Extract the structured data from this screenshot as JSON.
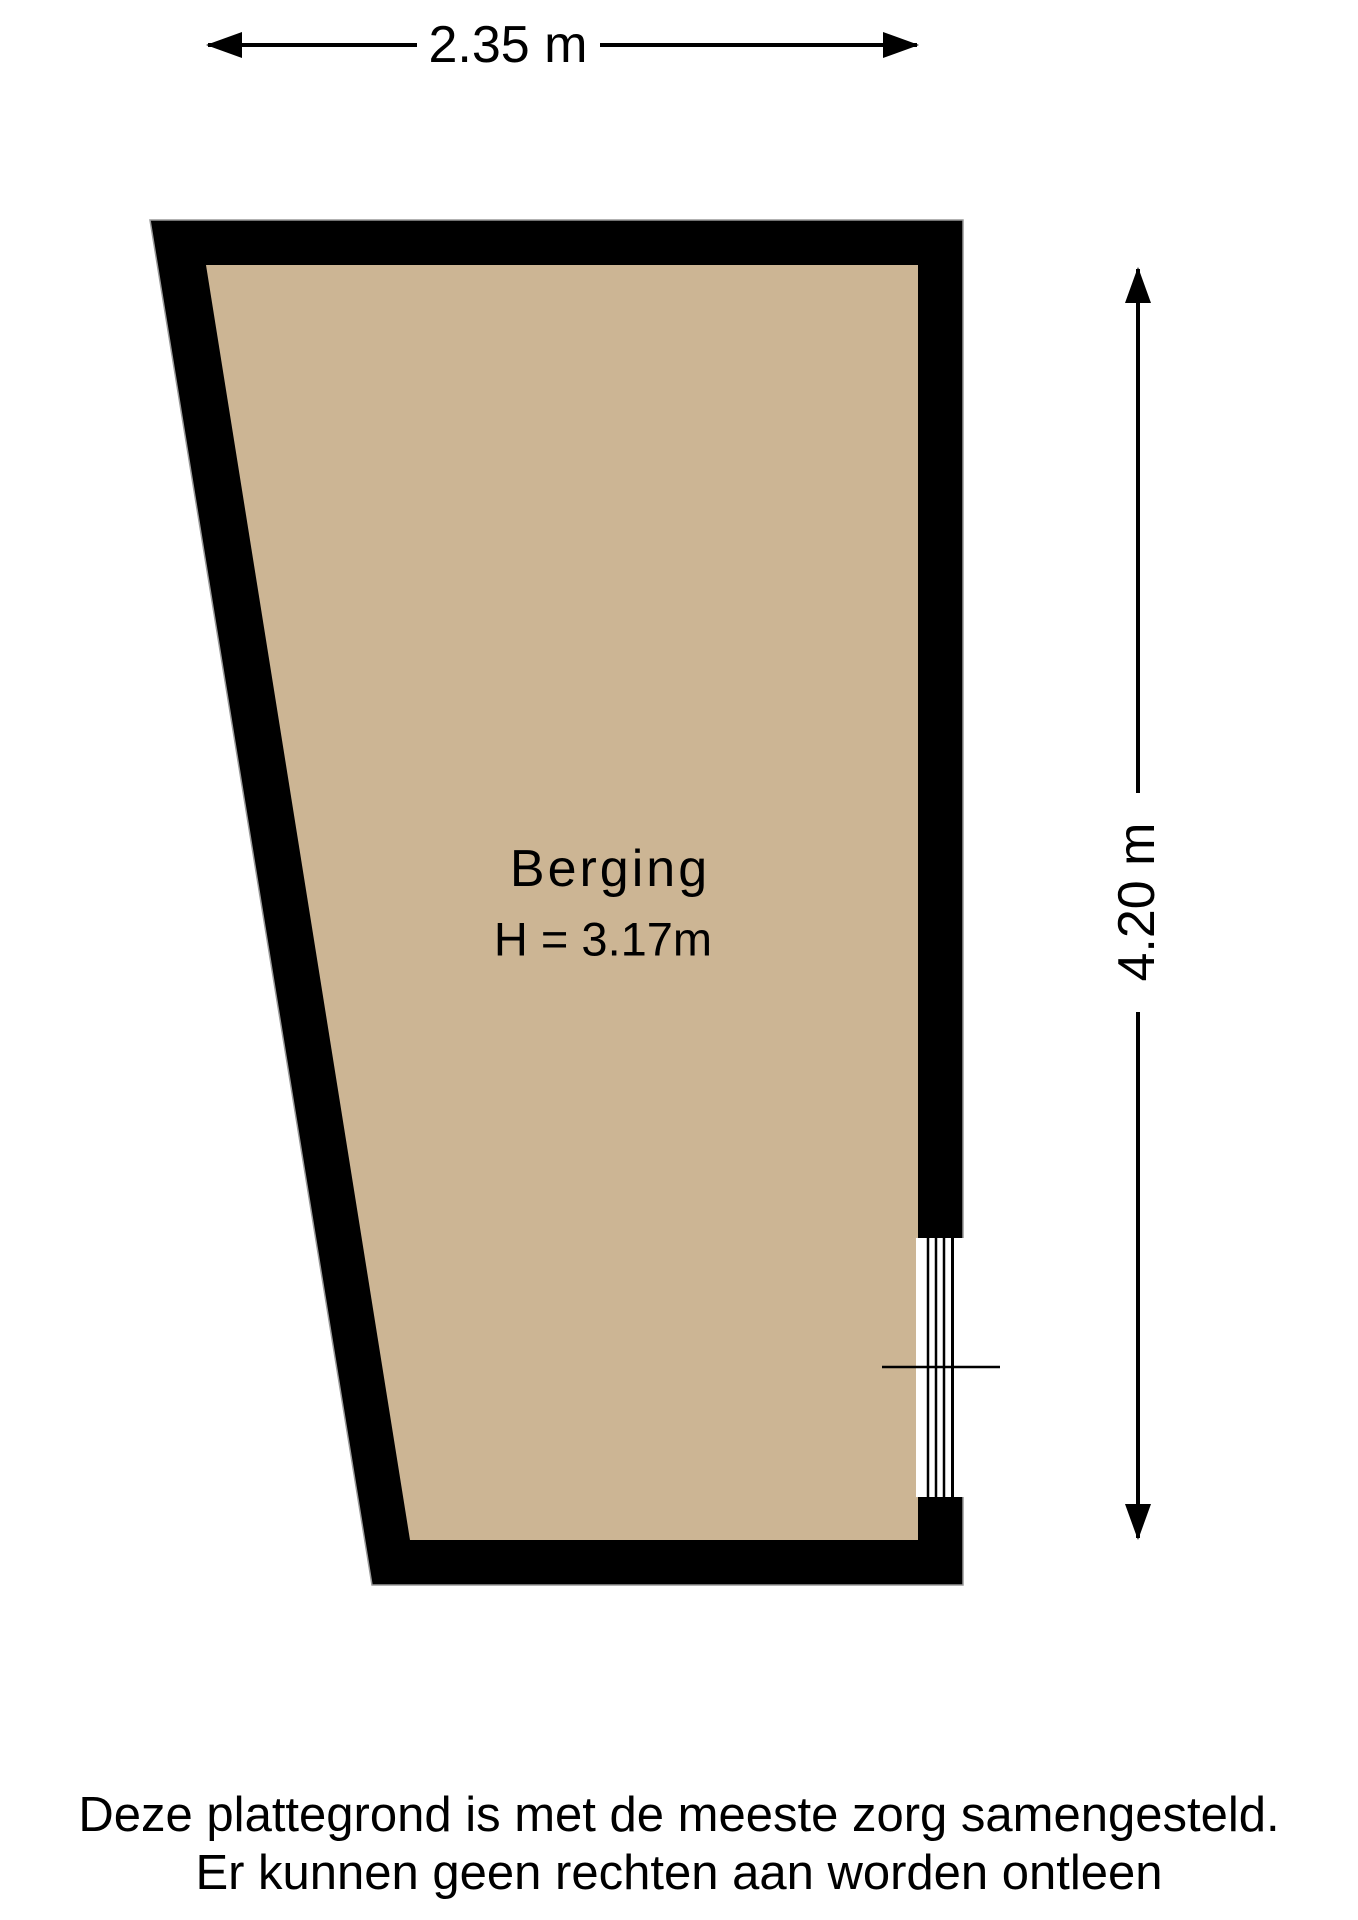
{
  "room": {
    "name": "Berging",
    "ceiling_height": "H = 3.17m"
  },
  "dimensions": {
    "width": "2.35 m",
    "depth": "4.20 m"
  },
  "disclaimer": {
    "line1": "Deze plattegrond is met de meeste zorg samengesteld.",
    "line2": "Er kunnen geen rechten aan worden ontleen"
  },
  "colors": {
    "wall": "#000000",
    "floor": "#ccb594",
    "line": "#000000",
    "wall_outline": "#999999",
    "background": "#ffffff"
  }
}
